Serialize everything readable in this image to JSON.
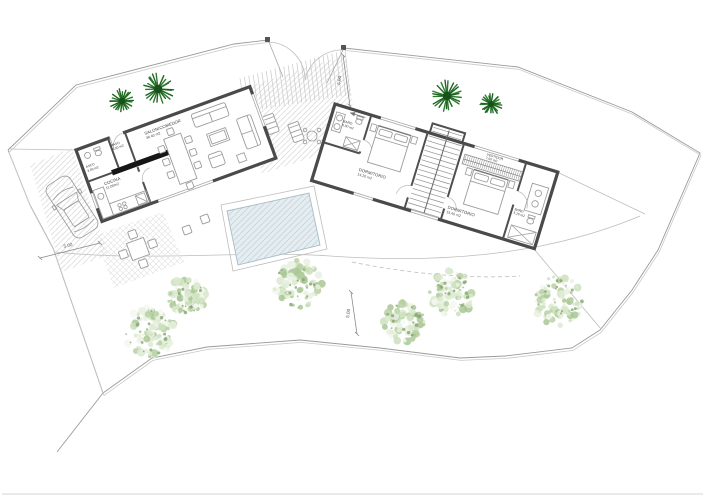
{
  "plan_type": "single-storey villa floor / site plan",
  "rooms": [
    {
      "id": "salon",
      "name": "SALON/COMEDOR",
      "area": "36.40 m2"
    },
    {
      "id": "paso",
      "name": "PASO",
      "area": "1.50 m2"
    },
    {
      "id": "aseo",
      "name": "ASEO",
      "area": "3.00 m2"
    },
    {
      "id": "cocina",
      "name": "COCINA",
      "area": "11.00m2"
    },
    {
      "id": "bano-1",
      "name": "BAÑO",
      "area": "5.00 m2"
    },
    {
      "id": "dorm-1",
      "name": "DORMITORIO",
      "area": "14.20 m2"
    },
    {
      "id": "vestidor",
      "name": "VESTIDOR",
      "area": "7.60 m2"
    },
    {
      "id": "dorm-2",
      "name": "DORMITORIO",
      "area": "15.40 m2"
    },
    {
      "id": "bano-2",
      "name": "BAÑO",
      "area": "5.20 m2"
    }
  ],
  "dimensions": {
    "parking": "5.00",
    "garden": "5.00",
    "entrance": "5.00"
  },
  "icons": {
    "palm_tree": "palm-tree-icon",
    "garden_tree": "garden-tree-icon",
    "car": "car-icon",
    "pool": "swimming-pool",
    "gate": "entrance-gate"
  },
  "colors": {
    "wall": "#4a4a4a",
    "partition": "#4f4f4f",
    "boundary": "#9a9a9a",
    "furniture": "#9b9b9b",
    "paving_hatch": "#d6d6d6",
    "pool_fill": "#e4edf1",
    "pool_hatch": "#c6d6dd",
    "palm_green": "#1d6420",
    "garden_tree_green": "#b7d1a2",
    "label_text": "#3c3c3c"
  }
}
